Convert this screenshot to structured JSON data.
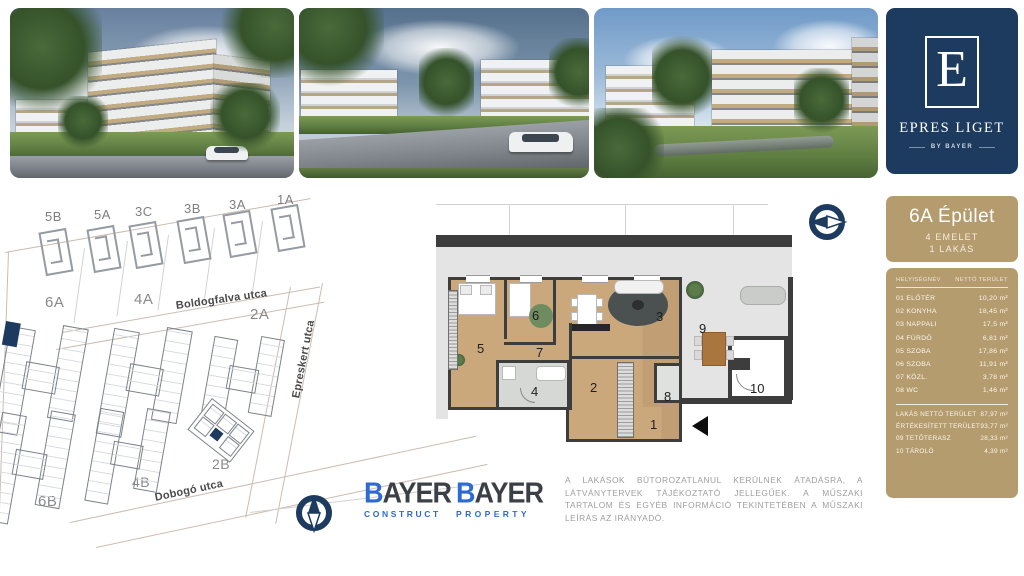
{
  "brand": {
    "initial": "E",
    "name": "EPRES LIGET",
    "byline": "BY BAYER"
  },
  "unit_panel": {
    "title": "6A Épület",
    "floors": "4 EMELET",
    "units": "1 LAKÁS",
    "col_room": "HELYISÉGNÉV",
    "col_area": "NETTÓ TERÜLET",
    "rows": [
      {
        "name": "01 ELŐTÉR",
        "area": "10,20 m²"
      },
      {
        "name": "02 KONYHA",
        "area": "18,45 m²"
      },
      {
        "name": "03 NAPPALI",
        "area": "17,5 m²"
      },
      {
        "name": "04 FÜRDŐ",
        "area": "6,81 m²"
      },
      {
        "name": "05 SZOBA",
        "area": "17,86 m²"
      },
      {
        "name": "06 SZOBA",
        "area": "11,91 m²"
      },
      {
        "name": "07 KÖZL.",
        "area": "3,78 m²"
      },
      {
        "name": "08 WC",
        "area": "1,46 m²"
      }
    ],
    "summary": [
      {
        "name": "LAKÁS NETTÓ TERÜLET",
        "area": "87,97 m²"
      },
      {
        "name": "ÉRTÉKESÍTETT TERÜLET",
        "area": "93,77 m²"
      },
      {
        "name": "09 TETŐTERASZ",
        "area": "28,33 m²"
      },
      {
        "name": "10 TÁROLÓ",
        "area": "4,39 m²"
      }
    ]
  },
  "site_plan": {
    "top_buildings": [
      "5B",
      "5A",
      "3C",
      "3B",
      "3A",
      "1A"
    ],
    "block_labels": [
      "6A",
      "4A",
      "2A",
      "2B",
      "4B",
      "6B"
    ],
    "streets": [
      "Boldogfalva utca",
      "Epreskert utca",
      "Dobogó utca"
    ]
  },
  "floor_plan": {
    "rooms": [
      "1",
      "2",
      "3",
      "4",
      "5",
      "6",
      "7",
      "8",
      "9",
      "10"
    ]
  },
  "footer": {
    "logo_construct": {
      "initial": "B",
      "rest": "AYER",
      "division": "CONSTRUCT"
    },
    "logo_property": {
      "initial": "B",
      "rest": "AYER",
      "division": "PROPERTY"
    },
    "disclaimer": "A LAKÁSOK BÚTOROZATLANUL KERÜLNEK ÁTADÁSRA, A LÁTVÁNYTERVEK TÁJÉKOZTATÓ JELLEGŰEK. A MŰSZAKI TARTALOM ÉS EGYÉB INFORMÁCIÓ TEKINTETÉBEN A MŰSZAKI LEÍRÁS AZ IRÁNYADÓ."
  },
  "colors": {
    "navy": "#1d3a5f",
    "tan": "#b59c6e",
    "blue": "#2e6ad1"
  }
}
